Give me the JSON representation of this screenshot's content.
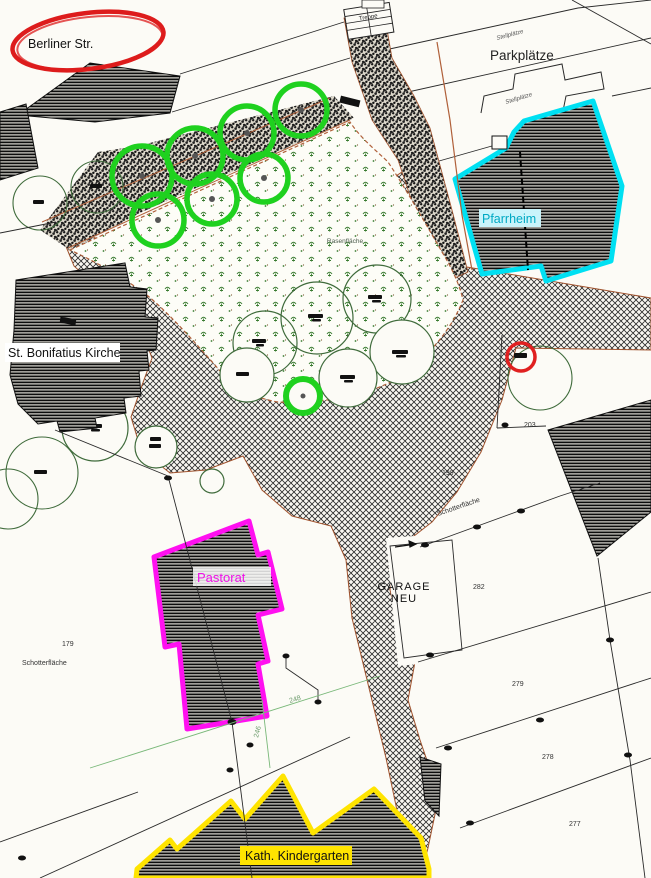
{
  "labels": {
    "street": "Berliner Str.",
    "parking": "Parkplätze",
    "stairs": "Treppe",
    "parish_hall": "Pfarrheim",
    "church": "St. Bonifatius Kirche",
    "lawn": "Rasenfläche",
    "rectory": "Pastorat",
    "garage_line1": "GARAGE",
    "garage_line2": "NEU",
    "kindergarten": "Kath. Kindergarten",
    "gravel_left": "Schotterfläche",
    "gravel_right": "Schotterfläche",
    "stalls_top": "Stellplätze",
    "stalls_mid": "Stellplätze"
  },
  "parcel_numbers": {
    "p279": "279",
    "p278": "278",
    "p277": "277",
    "p282": "282",
    "p203": "203",
    "p199": "199",
    "p179": "179"
  },
  "survey_numbers": {
    "g248": "248",
    "g246": "246"
  },
  "annotation_colors": {
    "red": "#dd1c1c",
    "green": "#1fd11f",
    "cyan": "#00e0f2",
    "magenta": "#ff10f0",
    "yellow": "#ffe400"
  }
}
